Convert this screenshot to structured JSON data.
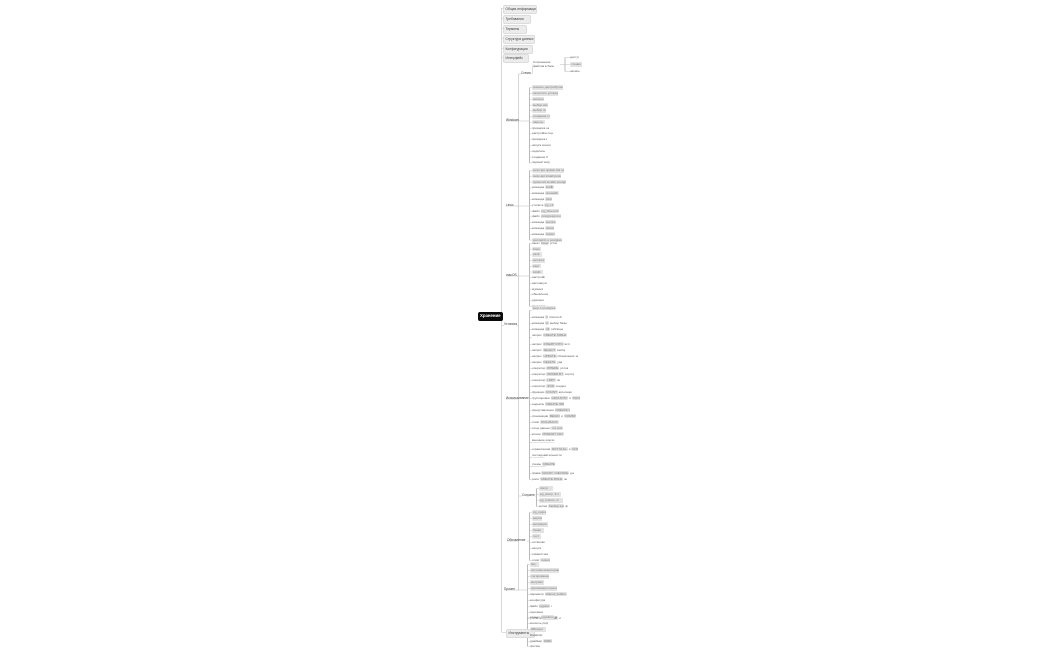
{
  "palette": {
    "background": "#ffffff",
    "link_line": "#c6c6c6",
    "bracket_line": "#9e9e9e",
    "chip_bg": "#e3e3e3",
    "chip_text": "#7c7c7c",
    "plain_text": "#5a5a5a",
    "root_bg": "#0a0a0a",
    "root_text": "#ffffff"
  },
  "root": {
    "label": "Хранение",
    "x": 478,
    "y": 312,
    "w": 21,
    "h": 9
  },
  "top_items": [
    {
      "t": "Общая информация",
      "x": 503,
      "y": 5,
      "w": 29
    },
    {
      "t": "Требования",
      "x": 503,
      "y": 15,
      "w": 23
    },
    {
      "t": "Термины",
      "x": 503,
      "y": 25,
      "w": 19
    },
    {
      "t": "Структура данных",
      "x": 503,
      "y": 35,
      "w": 27
    },
    {
      "t": "Конфигурация",
      "x": 503,
      "y": 45,
      "w": 25
    },
    {
      "t": "Интерфейс",
      "x": 503,
      "y": 54,
      "w": 21
    }
  ],
  "branch": {
    "label": "Установка",
    "x": 504,
    "y": 322,
    "w": 13,
    "h": 7,
    "clusters": [
      {
        "name": "schema",
        "label": {
          "t": "Схема",
          "x": 521,
          "y": 71,
          "w": 11
        },
        "mid": {
          "t": "Сохранение файлов в базе данных",
          "x": 533,
          "y": 60,
          "w": 27,
          "h": 9,
          "s": "text",
          "two": true
        },
        "bracketX": 565,
        "rows": [
          {
            "s": "text",
            "t": "доступ",
            "x": 570,
            "y": 55,
            "w": 9
          },
          {
            "s": "chip",
            "t": "чтение",
            "x": 570,
            "y": 62,
            "w": 12
          },
          {
            "s": "text",
            "t": "запись",
            "x": 570,
            "y": 69,
            "w": 10
          }
        ]
      },
      {
        "name": "windows",
        "label": {
          "t": "Windows",
          "x": 506,
          "y": 118,
          "w": 13
        },
        "bracketX": 529.5,
        "rowX": 532,
        "startY": 85.2,
        "stepY": 5.78,
        "rows": [
          {
            "s": "chip",
            "t": "скачать дистрибутив",
            "w": 31
          },
          {
            "s": "chip",
            "t": "запустить установщик",
            "w": 26
          },
          {
            "s": "chip",
            "t": "setup.exe",
            "w": 12
          },
          {
            "s": "chip",
            "t": "выбор каталога",
            "w": 16
          },
          {
            "s": "chip",
            "t": "выбор порта",
            "w": 14
          },
          {
            "s": "chip",
            "t": "создание службы",
            "w": 18
          },
          {
            "s": "chip",
            "t": "пароль",
            "w": 13
          },
          {
            "s": "text",
            "t": "проверка запуска",
            "w": 17
          },
          {
            "s": "text",
            "t": "настройка переменных",
            "w": 21
          },
          {
            "s": "text",
            "t": "проверка версии",
            "w": 15
          },
          {
            "s": "text",
            "t": "запуск консоли",
            "w": 19
          },
          {
            "s": "text",
            "t": "подключение",
            "w": 13
          },
          {
            "s": "text",
            "t": "создание базы",
            "w": 16
          },
          {
            "s": "text",
            "t": "первый запуск",
            "w": 18
          }
        ]
      },
      {
        "name": "linux",
        "label": {
          "t": "Linux",
          "x": 506,
          "y": 203,
          "w": 10
        },
        "bracketX": 529.5,
        "rowX": 532,
        "startY": 168,
        "stepY": 5.8,
        "rows": [
          {
            "s": "chip",
            "t": "sudo apt update && upgrade",
            "w": 32
          },
          {
            "s": "chip",
            "t": "sudo apt install postgresql",
            "w": 29
          },
          {
            "s": "chip",
            "t": "systemctl enable postgresql",
            "w": 34
          },
          {
            "s": "mixed",
            "t": "команда `initdb`",
            "w": 24
          },
          {
            "s": "mixed",
            "t": "команда `createdb`",
            "w": 27
          },
          {
            "s": "mixed",
            "t": "команда `psql`",
            "w": 22
          },
          {
            "s": "mixed",
            "t": "утилита `pg_ctl`",
            "w": 25
          },
          {
            "s": "mixed",
            "t": "файл `pg_hba.conf`",
            "w": 27
          },
          {
            "s": "mixed",
            "t": "файл `postgresql.conf`",
            "w": 29
          },
          {
            "s": "mixed",
            "t": "команда `service`",
            "w": 24
          },
          {
            "s": "mixed",
            "t": "команда `reload`",
            "w": 22
          },
          {
            "s": "mixed",
            "t": "команда `restart`",
            "w": 25
          },
          {
            "s": "chip",
            "t": "journalctl -u postgresql",
            "w": 30
          }
        ]
      },
      {
        "name": "macos",
        "label": {
          "t": "macOS",
          "x": 506,
          "y": 273,
          "w": 11
        },
        "bracketX": 529.5,
        "rowX": 532,
        "startY": 241,
        "stepY": 5.7,
        "rows": [
          {
            "s": "mixed",
            "t": "пакет `brew` установка",
            "w": 25
          },
          {
            "s": "chip",
            "t": "brew",
            "w": 9
          },
          {
            "s": "chip",
            "t": "cask",
            "w": 10
          },
          {
            "s": "chip",
            "t": "services",
            "w": 13
          },
          {
            "s": "chip",
            "t": "psql",
            "w": 9
          },
          {
            "s": "chip",
            "t": "initdb",
            "w": 11
          },
          {
            "s": "text",
            "t": "настройки",
            "w": 13
          },
          {
            "s": "text",
            "t": "автозапуск",
            "w": 15
          },
          {
            "s": "text",
            "t": "журналы",
            "w": 11
          },
          {
            "s": "text",
            "t": "обновления",
            "w": 16
          },
          {
            "s": "text",
            "t": "удаление",
            "w": 12
          },
          {
            "s": "text",
            "t": "проверка",
            "w": 14
          }
        ]
      },
      {
        "name": "usage",
        "label": {
          "t": "Использование",
          "x": 506,
          "y": 396,
          "w": 24
        },
        "bracketX": 529.5,
        "rowX": 532,
        "rows": [
          {
            "s": "mixed",
            "t": "`psql -U postgres` подключение к серверу",
            "y": 306,
            "w": 42,
            "two": true
          },
          {
            "s": "mixed",
            "t": "команда `\\l` список баз",
            "y": 315,
            "w": 30
          },
          {
            "s": "mixed",
            "t": "команда `\\c` выбор базы",
            "y": 321,
            "w": 36
          },
          {
            "s": "mixed",
            "t": "команда `\\dt` таблицы",
            "y": 327,
            "w": 31
          },
          {
            "s": "mixed",
            "t": "запрос `CREATE TABLE` создание таблицы",
            "y": 333,
            "w": 44,
            "two": true
          },
          {
            "s": "mixed",
            "t": "запрос `INSERT INTO` вставка",
            "y": 342,
            "w": 38
          },
          {
            "s": "mixed",
            "t": "запрос `SELECT` выборка",
            "y": 348,
            "w": 33
          },
          {
            "s": "mixed",
            "t": "запрос `UPDATE` обновление записей",
            "y": 354,
            "w": 46
          },
          {
            "s": "mixed",
            "t": "запрос `DELETE` удаление",
            "y": 360,
            "w": 30
          },
          {
            "s": "mixed",
            "t": "оператор `WHERE` условия",
            "y": 366,
            "w": 36
          },
          {
            "s": "mixed",
            "t": "оператор `ORDER BY` сортировка",
            "y": 372,
            "w": 42
          },
          {
            "s": "mixed",
            "t": "оператор `LIMIT` лимит",
            "y": 378,
            "w": 28
          },
          {
            "s": "mixed",
            "t": "оператор `JOIN` соединения",
            "y": 384,
            "w": 34
          },
          {
            "s": "mixed",
            "t": "функции `COUNT` агрегация",
            "y": 390,
            "w": 40
          },
          {
            "s": "mixed",
            "t": "группировка `GROUP BY` и `HAVING`",
            "y": 396,
            "w": 48
          },
          {
            "s": "mixed",
            "t": "индексы `CREATE INDEX`",
            "y": 402,
            "w": 32
          },
          {
            "s": "mixed",
            "t": "представления `CREATE VIEW`",
            "y": 408,
            "w": 38
          },
          {
            "s": "mixed",
            "t": "транзакции `BEGIN` и `COMMIT`",
            "y": 414,
            "w": 44
          },
          {
            "s": "mixed",
            "t": "откат `ROLLBACK`",
            "y": 420,
            "w": 30
          },
          {
            "s": "mixed",
            "t": "типы данных `int, text`",
            "y": 426,
            "w": 36
          },
          {
            "s": "mixed",
            "t": "ключи `PRIMARY KEY`",
            "y": 432,
            "w": 40
          },
          {
            "s": "mixed",
            "t": "внешние ключи `FOREIGN KEY` связи",
            "y": 438,
            "w": 34,
            "two": true
          },
          {
            "s": "mixed",
            "t": "ограничения `NOT NULL` и `UNIQUE`",
            "y": 447,
            "w": 46
          },
          {
            "s": "mixed",
            "t": "последовательности `SERIAL` счётчики",
            "y": 453,
            "w": 38,
            "two": true
          },
          {
            "s": "mixed",
            "t": "схемы `CREATE SCHEMA`",
            "y": 462,
            "w": 30,
            "two": true
          },
          {
            "s": "mixed",
            "t": "права `GRANT / REVOKE` доступ",
            "y": 471,
            "w": 42
          },
          {
            "s": "mixed",
            "t": "роли `CREATE ROLE` пользователи",
            "y": 477,
            "w": 35
          }
        ]
      },
      {
        "name": "saving",
        "label": {
          "t": "Сохранение",
          "x": 522,
          "y": 493,
          "w": 13
        },
        "bracketX": 536.5,
        "rowX": 539,
        "rows": [
          {
            "s": "chip",
            "t": "dump",
            "y": 486,
            "w": 14
          },
          {
            "s": "chip",
            "t": "pg_dump -F c",
            "y": 492,
            "w": 22
          },
          {
            "s": "chip",
            "t": "pg_restore -d",
            "y": 498,
            "w": 24
          },
          {
            "s": "mixed",
            "t": "копия `backup.sql` файл",
            "y": 504,
            "w": 29
          }
        ]
      },
      {
        "name": "update",
        "label": {
          "t": "Обновление",
          "x": 507,
          "y": 538,
          "w": 20
        },
        "bracketX": 529.5,
        "rowX": 532,
        "startY": 510,
        "stepY": 6,
        "rows": [
          {
            "s": "chip",
            "t": "pg_upgrade",
            "w": 14
          },
          {
            "s": "chip",
            "t": "версии",
            "w": 10
          },
          {
            "s": "chip",
            "t": "миграции",
            "w": 16
          },
          {
            "s": "chip",
            "t": "бэкап",
            "w": 12
          },
          {
            "s": "chip",
            "t": "тест",
            "w": 9
          },
          {
            "s": "text",
            "t": "остановка",
            "w": 13
          },
          {
            "s": "text",
            "t": "запуск",
            "w": 10
          },
          {
            "s": "text",
            "t": "совместимость",
            "w": 16
          },
          {
            "s": "mixed",
            "t": "откат `restore`",
            "w": 18
          }
        ]
      },
      {
        "name": "misc",
        "label": {
          "t": "Прочее",
          "x": 504,
          "y": 587,
          "w": 13
        },
        "bracketX": 527.5,
        "rowX": 530,
        "startY": 562,
        "stepY": 6,
        "rows": [
          {
            "s": "chip",
            "t": "faq",
            "w": 9
          },
          {
            "s": "chip",
            "t": "система мониторинга",
            "w": 29
          },
          {
            "s": "chip",
            "t": "логирование",
            "w": 19
          },
          {
            "s": "chip",
            "t": "метрики",
            "w": 14
          },
          {
            "s": "chip",
            "t": "производительность",
            "w": 27
          },
          {
            "s": "mixed",
            "t": "параметр `shared_buffers` память",
            "w": 37
          },
          {
            "s": "text",
            "t": "конфигурация",
            "w": 15
          },
          {
            "s": "mixed",
            "t": "файл `pgpass` пароли",
            "w": 22
          },
          {
            "s": "text",
            "t": "переменные",
            "w": 13
          },
          {
            "s": "mixed",
            "t": "утилита `vacuumdb` очистка",
            "w": 31
          }
        ]
      }
    ]
  },
  "bottom_branch": {
    "label": {
      "t": "Инструменты",
      "x": 506,
      "y": 629,
      "w": 24
    },
    "bracketX": 527.5,
    "rowX": 530,
    "rows": [
      {
        "s": "mixed",
        "t": "клиент `pgAdmin` интерфейс",
        "y": 615,
        "w": 27
      },
      {
        "s": "text",
        "t": "консоль psql",
        "y": 621,
        "w": 18
      },
      {
        "s": "chip",
        "t": "DBeaver",
        "y": 627,
        "w": 16
      },
      {
        "s": "text",
        "t": "DataGrip",
        "y": 633,
        "w": 13
      },
      {
        "s": "mixed",
        "t": "драйвер `JDBC` java",
        "y": 639,
        "w": 22
      },
      {
        "s": "text",
        "t": "прочие",
        "y": 644,
        "w": 11
      }
    ]
  },
  "layout": {
    "spine1_x": 501.5,
    "spine2_x": 518.5,
    "spine1_top": 8,
    "spine1_bottom": 632,
    "spine2_top": 74,
    "spine2_bottom": 590
  }
}
